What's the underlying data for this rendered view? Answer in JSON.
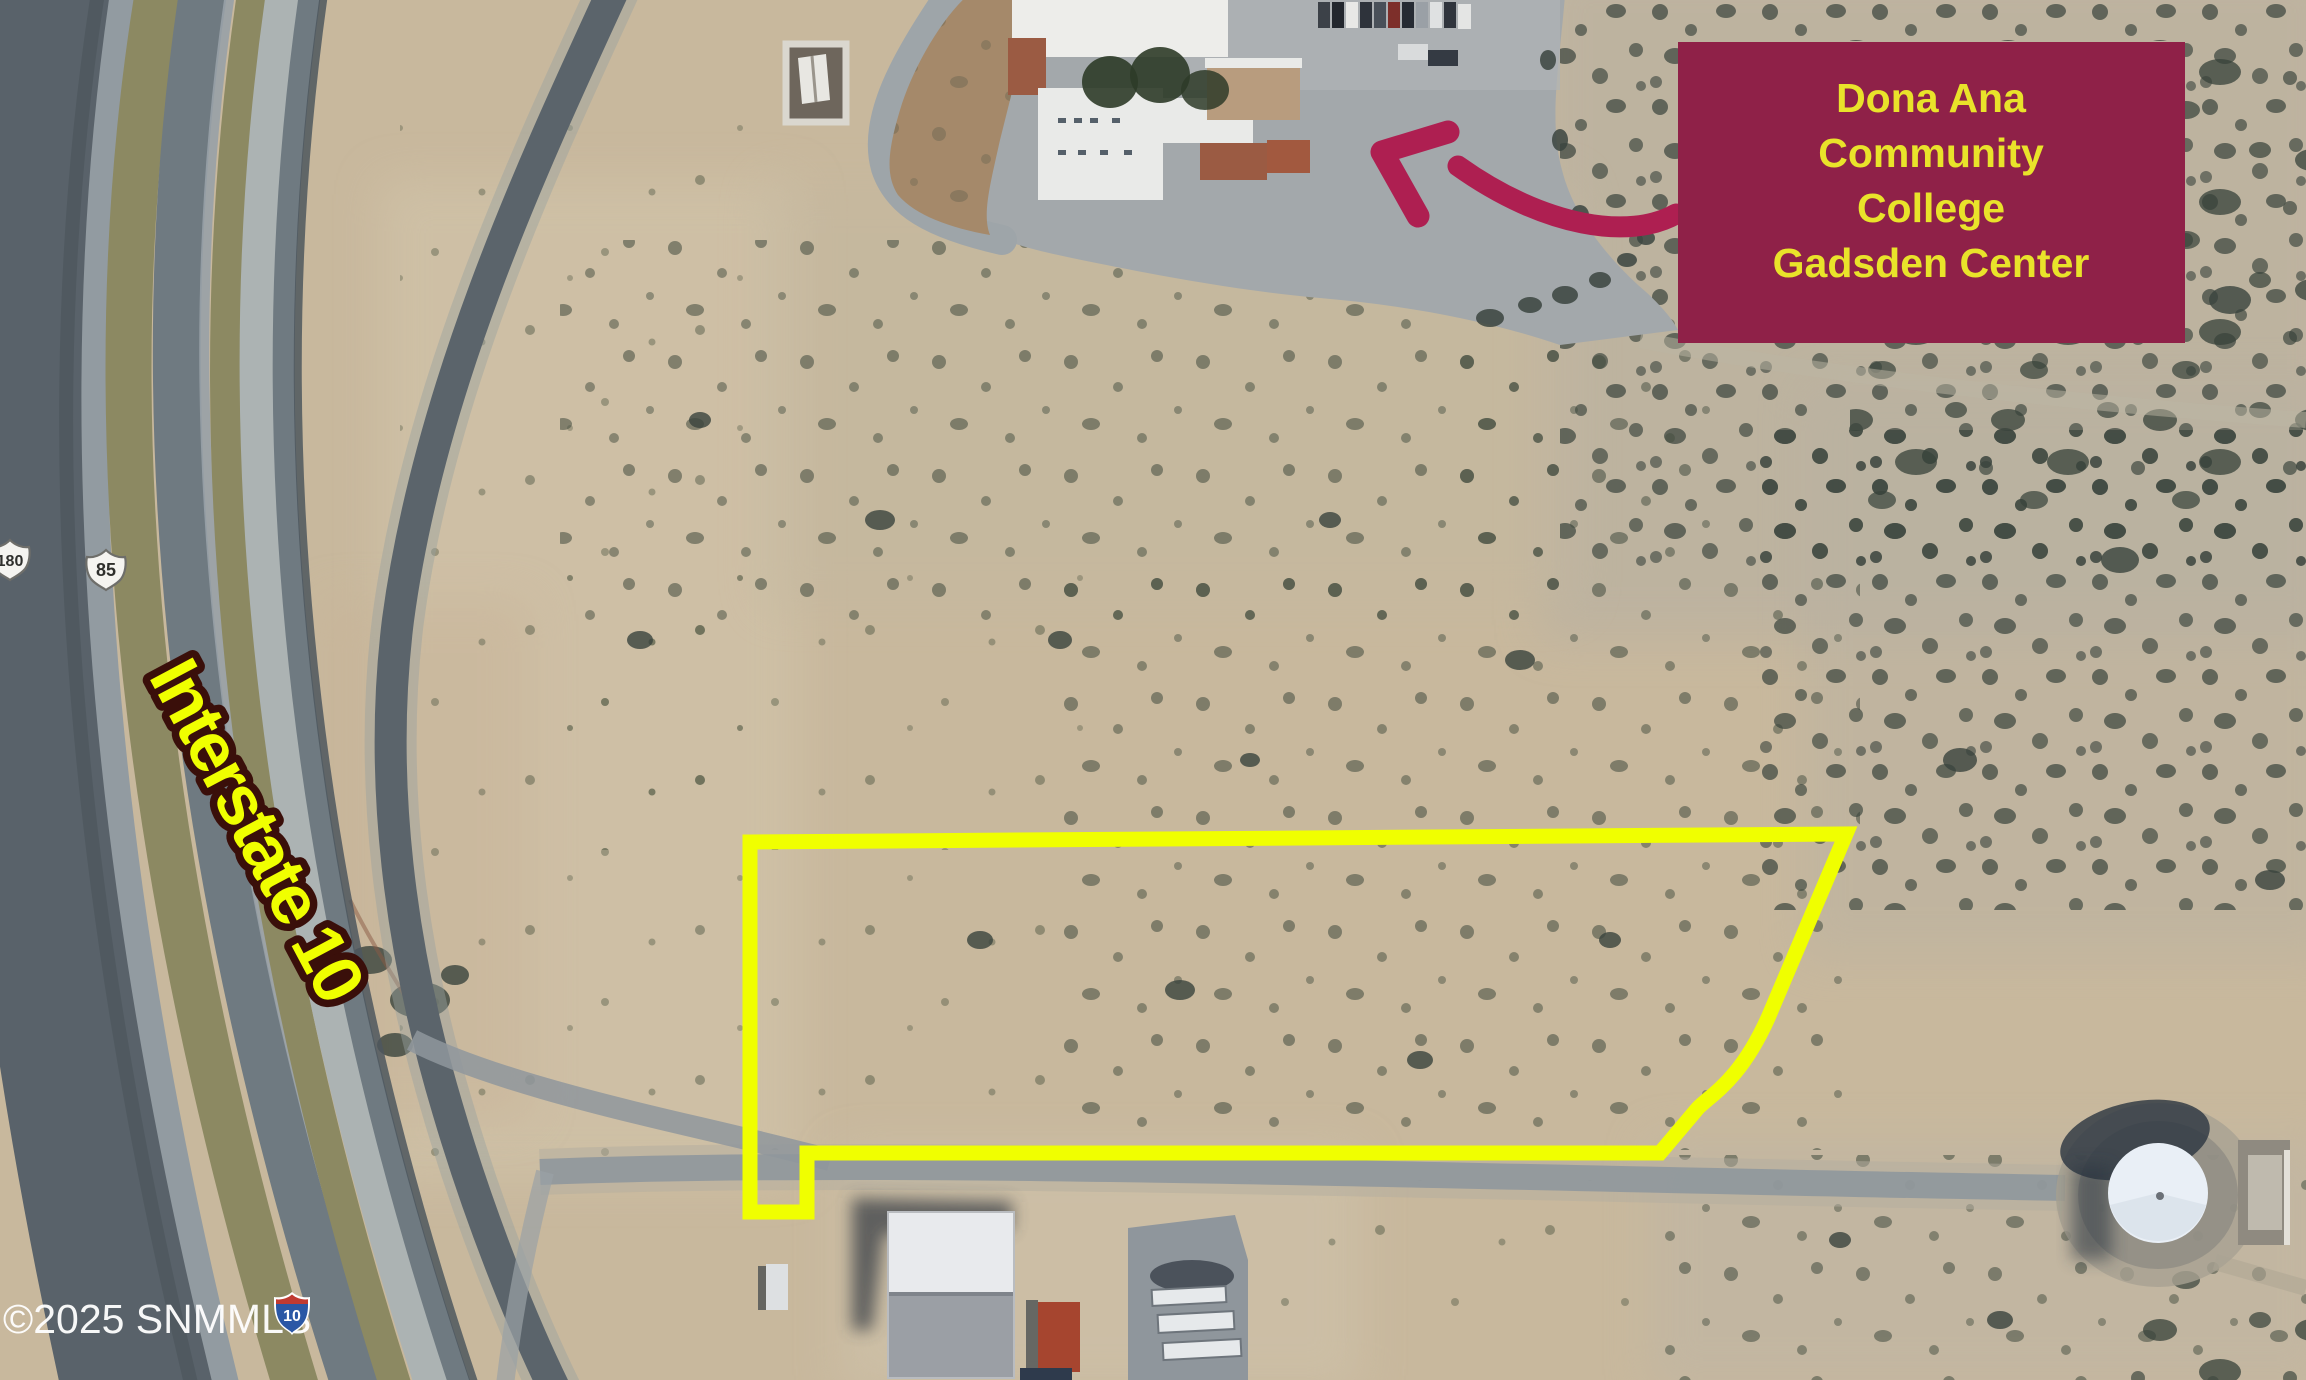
{
  "colors": {
    "annotation-yellow": "#F0FF00",
    "callout-bg": "#8F2148",
    "callout-text": "#E9E32A",
    "arrow": "#AE1F51",
    "label-outline": "#3A0F0A",
    "watermark": "#FFFFFF"
  },
  "callout": {
    "lines": [
      "Dona Ana",
      "Community",
      "College",
      "Gadsden Center"
    ]
  },
  "road_label": "Interstate 10",
  "watermark_text": "©2025 SNMMLS",
  "shields": {
    "us_route_180": "180",
    "us_route_85": "85",
    "interstate_10": "10"
  }
}
